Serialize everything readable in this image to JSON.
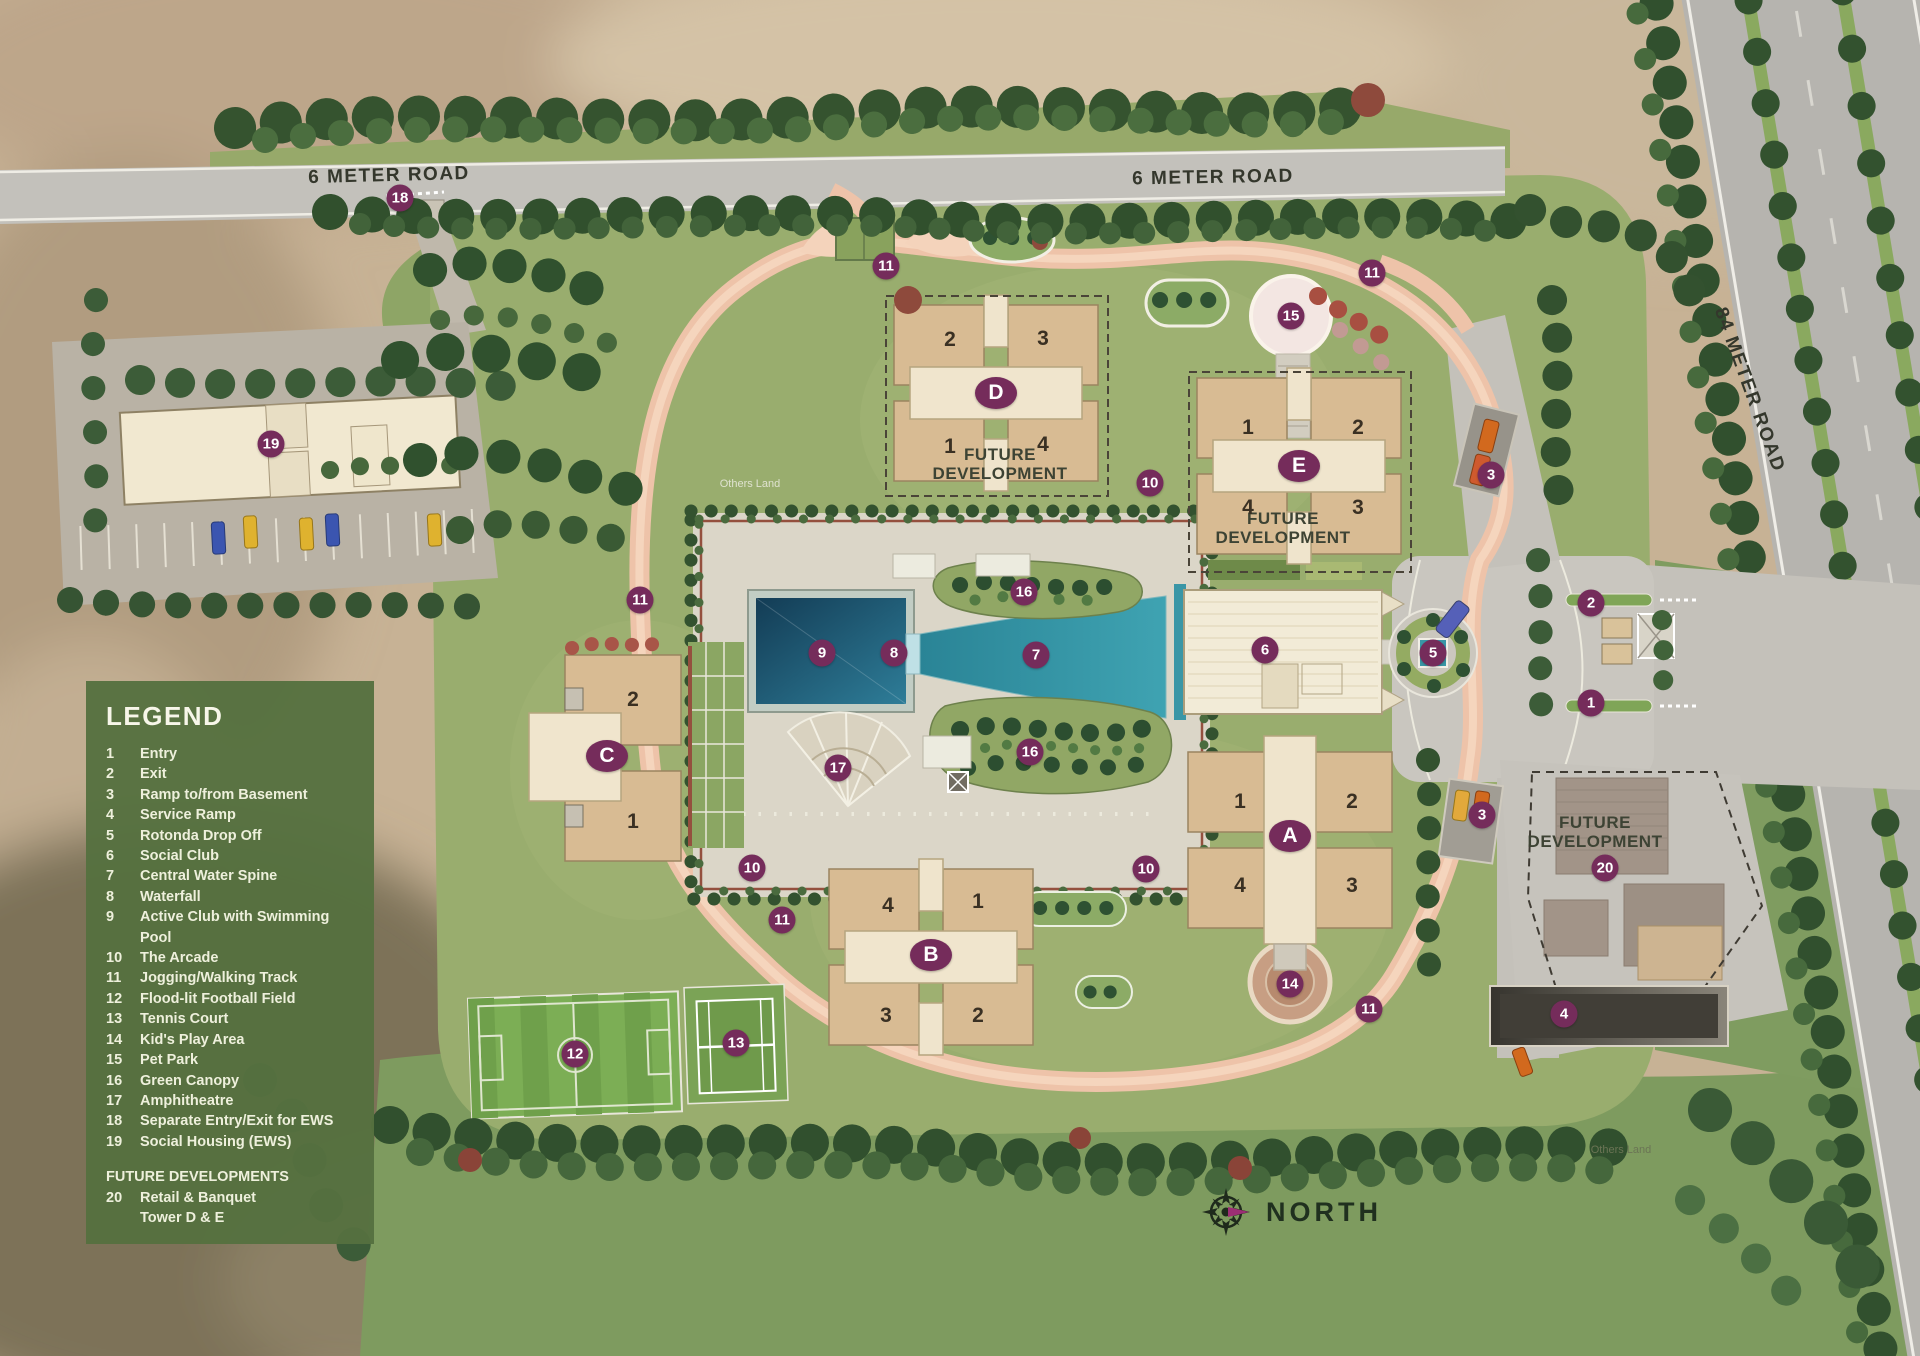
{
  "legend": {
    "title": "LEGEND",
    "items": [
      {
        "num": "1",
        "label": "Entry"
      },
      {
        "num": "2",
        "label": "Exit"
      },
      {
        "num": "3",
        "label": "Ramp to/from Basement"
      },
      {
        "num": "4",
        "label": "Service Ramp"
      },
      {
        "num": "5",
        "label": "Rotonda Drop Off"
      },
      {
        "num": "6",
        "label": "Social Club"
      },
      {
        "num": "7",
        "label": "Central Water Spine"
      },
      {
        "num": "8",
        "label": "Waterfall"
      },
      {
        "num": "9",
        "label": "Active Club with Swimming Pool"
      },
      {
        "num": "10",
        "label": "The Arcade"
      },
      {
        "num": "11",
        "label": "Jogging/Walking Track"
      },
      {
        "num": "12",
        "label": "Flood-lit Football Field"
      },
      {
        "num": "13",
        "label": "Tennis Court"
      },
      {
        "num": "14",
        "label": "Kid's Play Area"
      },
      {
        "num": "15",
        "label": "Pet Park"
      },
      {
        "num": "16",
        "label": "Green Canopy"
      },
      {
        "num": "17",
        "label": "Amphitheatre"
      },
      {
        "num": "18",
        "label": "Separate Entry/Exit for EWS"
      },
      {
        "num": "19",
        "label": "Social Housing (EWS)"
      }
    ],
    "future_title": "FUTURE DEVELOPMENTS",
    "future_items": [
      {
        "num": "20",
        "label": "Retail & Banquet"
      },
      {
        "num": "",
        "label": "Tower D & E"
      }
    ]
  },
  "compass": {
    "label": "NORTH"
  },
  "roads": {
    "labels": [
      {
        "text": "6 METER ROAD",
        "x": 389,
        "y": 176,
        "rot": -1.5
      },
      {
        "text": "6 METER ROAD",
        "x": 1213,
        "y": 178,
        "rot": -1
      },
      {
        "text": "84 METER ROAD",
        "x": 1749,
        "y": 390,
        "rot": 70
      }
    ]
  },
  "map": {
    "future_development_labels": [
      {
        "text": "FUTURE DEVELOPMENT",
        "x": 1000,
        "y": 464
      },
      {
        "text": "FUTURE DEVELOPMENT",
        "x": 1283,
        "y": 528
      },
      {
        "text": "FUTURE DEVELOPMENT",
        "x": 1595,
        "y": 832
      }
    ],
    "others_land_labels": [
      {
        "text": "Others Land",
        "x": 750,
        "y": 484,
        "color": "#dfe2cf"
      },
      {
        "text": "Others Land",
        "x": 1621,
        "y": 1150,
        "color": "#6b7455"
      }
    ],
    "towers": [
      {
        "label": "D",
        "x": 996,
        "y": 393
      },
      {
        "label": "E",
        "x": 1299,
        "y": 466
      },
      {
        "label": "C",
        "x": 607,
        "y": 756
      },
      {
        "label": "A",
        "x": 1290,
        "y": 836
      },
      {
        "label": "B",
        "x": 931,
        "y": 955
      }
    ],
    "units": [
      {
        "t": "2",
        "x": 950,
        "y": 340
      },
      {
        "t": "3",
        "x": 1043,
        "y": 339
      },
      {
        "t": "1",
        "x": 950,
        "y": 447
      },
      {
        "t": "4",
        "x": 1043,
        "y": 445
      },
      {
        "t": "1",
        "x": 1248,
        "y": 428
      },
      {
        "t": "2",
        "x": 1358,
        "y": 428
      },
      {
        "t": "4",
        "x": 1248,
        "y": 508
      },
      {
        "t": "3",
        "x": 1358,
        "y": 508
      },
      {
        "t": "2",
        "x": 633,
        "y": 700
      },
      {
        "t": "1",
        "x": 633,
        "y": 822
      },
      {
        "t": "1",
        "x": 1240,
        "y": 802
      },
      {
        "t": "2",
        "x": 1352,
        "y": 802
      },
      {
        "t": "4",
        "x": 1240,
        "y": 886
      },
      {
        "t": "3",
        "x": 1352,
        "y": 886
      },
      {
        "t": "4",
        "x": 888,
        "y": 906
      },
      {
        "t": "1",
        "x": 978,
        "y": 902
      },
      {
        "t": "3",
        "x": 886,
        "y": 1016
      },
      {
        "t": "2",
        "x": 978,
        "y": 1016
      }
    ],
    "markers": [
      {
        "n": "18",
        "x": 400,
        "y": 198
      },
      {
        "n": "11",
        "x": 886,
        "y": 266
      },
      {
        "n": "15",
        "x": 1291,
        "y": 316
      },
      {
        "n": "11",
        "x": 1372,
        "y": 273
      },
      {
        "n": "19",
        "x": 271,
        "y": 444
      },
      {
        "n": "10",
        "x": 1150,
        "y": 483
      },
      {
        "n": "3",
        "x": 1491,
        "y": 475
      },
      {
        "n": "11",
        "x": 640,
        "y": 600
      },
      {
        "n": "2",
        "x": 1591,
        "y": 603
      },
      {
        "n": "16",
        "x": 1024,
        "y": 592
      },
      {
        "n": "9",
        "x": 822,
        "y": 653
      },
      {
        "n": "8",
        "x": 894,
        "y": 653
      },
      {
        "n": "7",
        "x": 1036,
        "y": 655
      },
      {
        "n": "6",
        "x": 1265,
        "y": 650
      },
      {
        "n": "5",
        "x": 1433,
        "y": 653
      },
      {
        "n": "1",
        "x": 1591,
        "y": 703
      },
      {
        "n": "16",
        "x": 1030,
        "y": 752
      },
      {
        "n": "17",
        "x": 838,
        "y": 768
      },
      {
        "n": "10",
        "x": 752,
        "y": 868
      },
      {
        "n": "10",
        "x": 1146,
        "y": 869
      },
      {
        "n": "3",
        "x": 1482,
        "y": 815
      },
      {
        "n": "11",
        "x": 782,
        "y": 920
      },
      {
        "n": "20",
        "x": 1605,
        "y": 868
      },
      {
        "n": "14",
        "x": 1290,
        "y": 984
      },
      {
        "n": "11",
        "x": 1369,
        "y": 1009
      },
      {
        "n": "4",
        "x": 1564,
        "y": 1014
      },
      {
        "n": "13",
        "x": 736,
        "y": 1043
      },
      {
        "n": "12",
        "x": 575,
        "y": 1054
      }
    ]
  },
  "colors": {
    "badge": "#752c5b",
    "legend_bg": "#55703f",
    "water": "#2f8fa0",
    "track": "#eec3a9",
    "lawn": "#99ad6e",
    "road": "#c3c1bb"
  }
}
